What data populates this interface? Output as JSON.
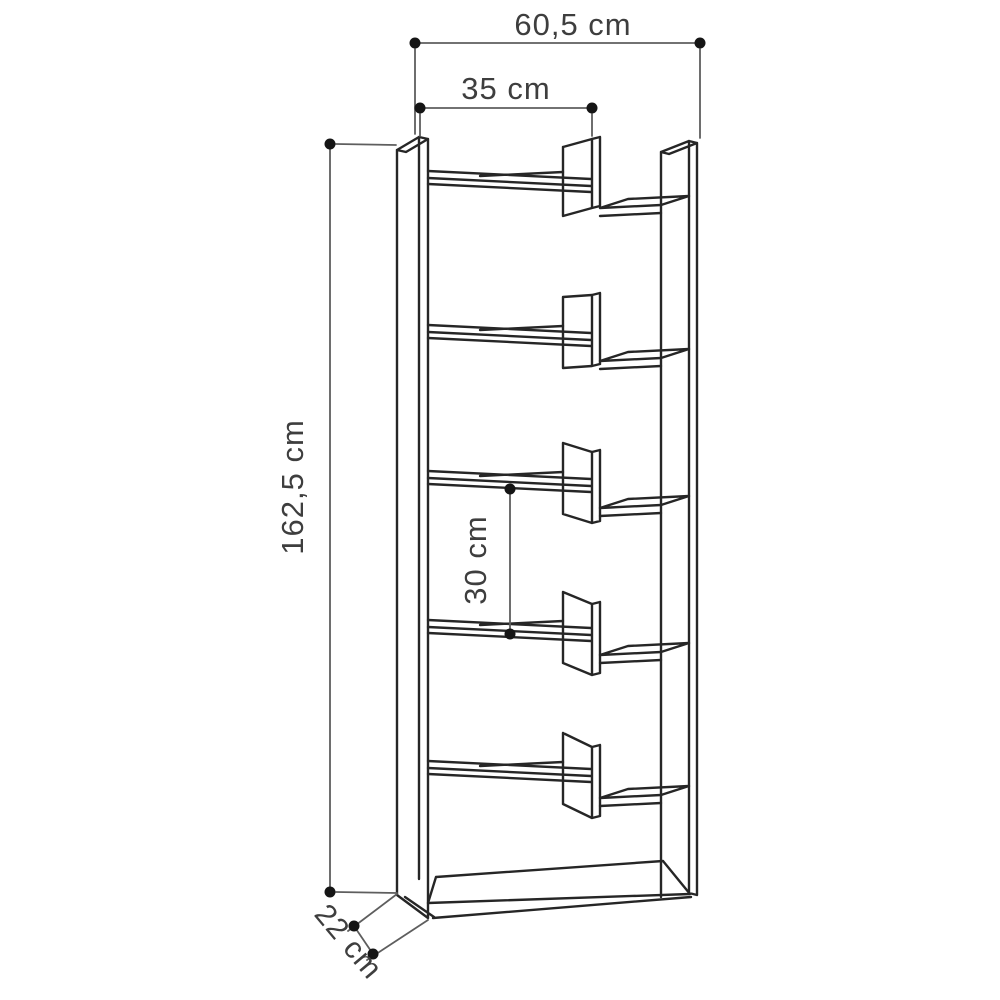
{
  "diagram": {
    "type": "furniture-dimension-drawing",
    "subject": "staggered-shelf bookcase line drawing",
    "dimensions": {
      "width_total": "60,5 cm",
      "width_inner": "35 cm",
      "height": "162,5 cm",
      "shelf_spacing": "30 cm",
      "depth": "22 cm"
    },
    "colors": {
      "background": "#ffffff",
      "drawing_line": "#262626",
      "dimension_line": "#5e5e5e",
      "dimension_dot": "#151515",
      "label_text": "#3e3e3e"
    }
  }
}
